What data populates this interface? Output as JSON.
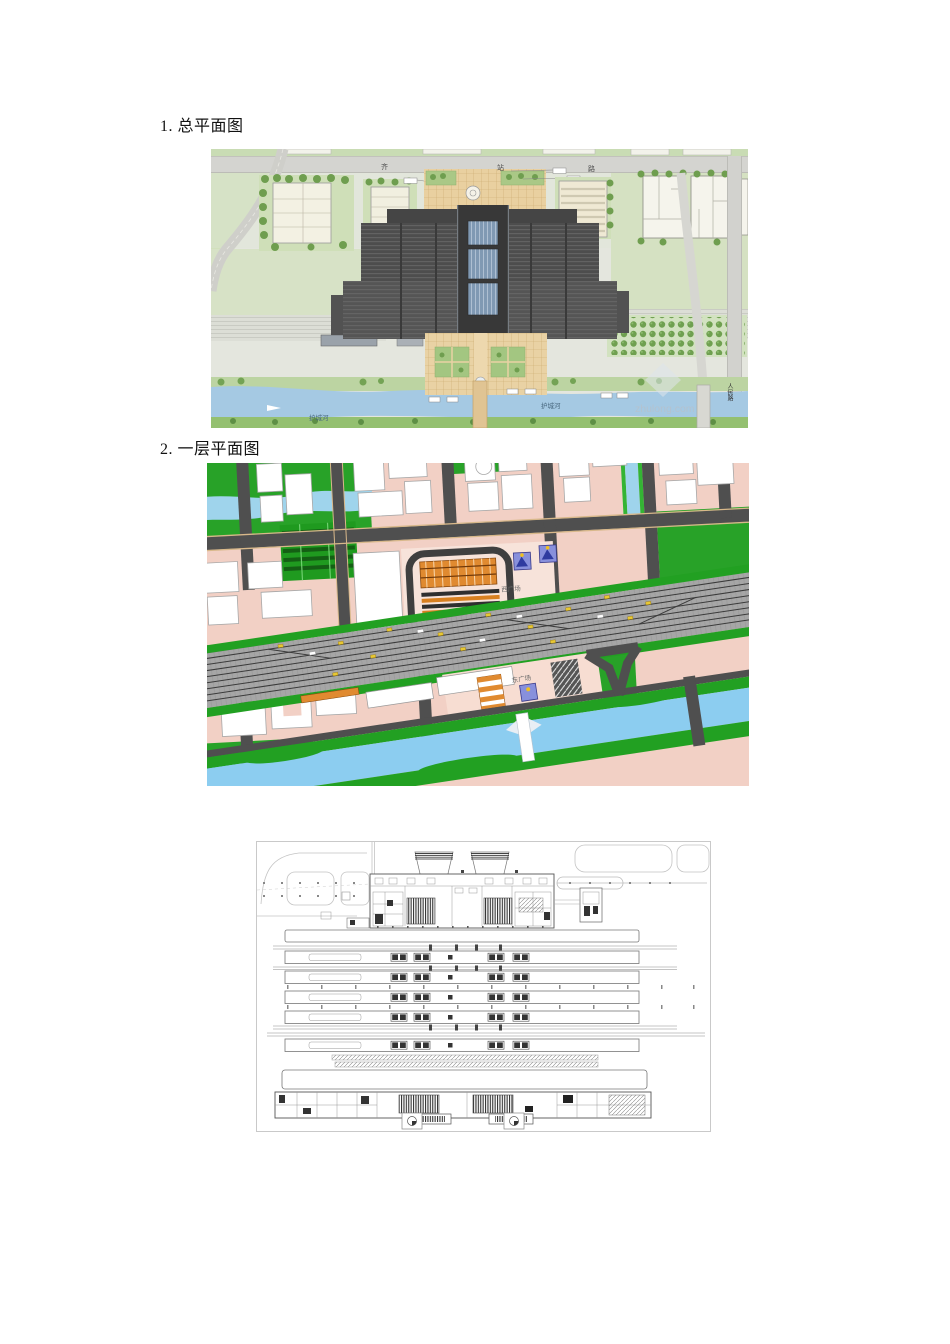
{
  "page": {
    "background": "#ffffff"
  },
  "headings": [
    {
      "id": "heading-1",
      "text": "1. 总平面图"
    },
    {
      "id": "heading-2",
      "text": "2. 一层平面图"
    }
  ],
  "figure1": {
    "labels": {
      "top_road_char_1": "齐",
      "top_road_char_2": "站",
      "top_road_char_3": "路",
      "river_left": "护城河",
      "river_right": "护城河",
      "right_road_vertical": "人民路",
      "watermark": "zhulong.com"
    },
    "colors": {
      "grass": "#d2e0bd",
      "plaza_tan": "#e9d0a0",
      "station_dark": "#4d4d4d",
      "glass_blue": "#8099b3",
      "river_blue": "#a5c9e3",
      "road_gray": "#d4d4d0",
      "tree_green": "#6f9e4f"
    }
  },
  "figure2": {
    "labels": {
      "west_square": "西广场",
      "east_square": "东广场"
    },
    "colors": {
      "block_pink": "#f2d0c5",
      "park_green": "#28a228",
      "road_dark": "#4f4f4f",
      "water_blue": "#9fd4ec",
      "rail_gray": "#a6a6a6",
      "terminal_orange": "#e08a30",
      "metro_blue": "#8890dc"
    }
  },
  "figure3": {
    "colors": {
      "line": "#777777",
      "dark_fill": "#333333",
      "border": "#c9c9c9"
    }
  }
}
